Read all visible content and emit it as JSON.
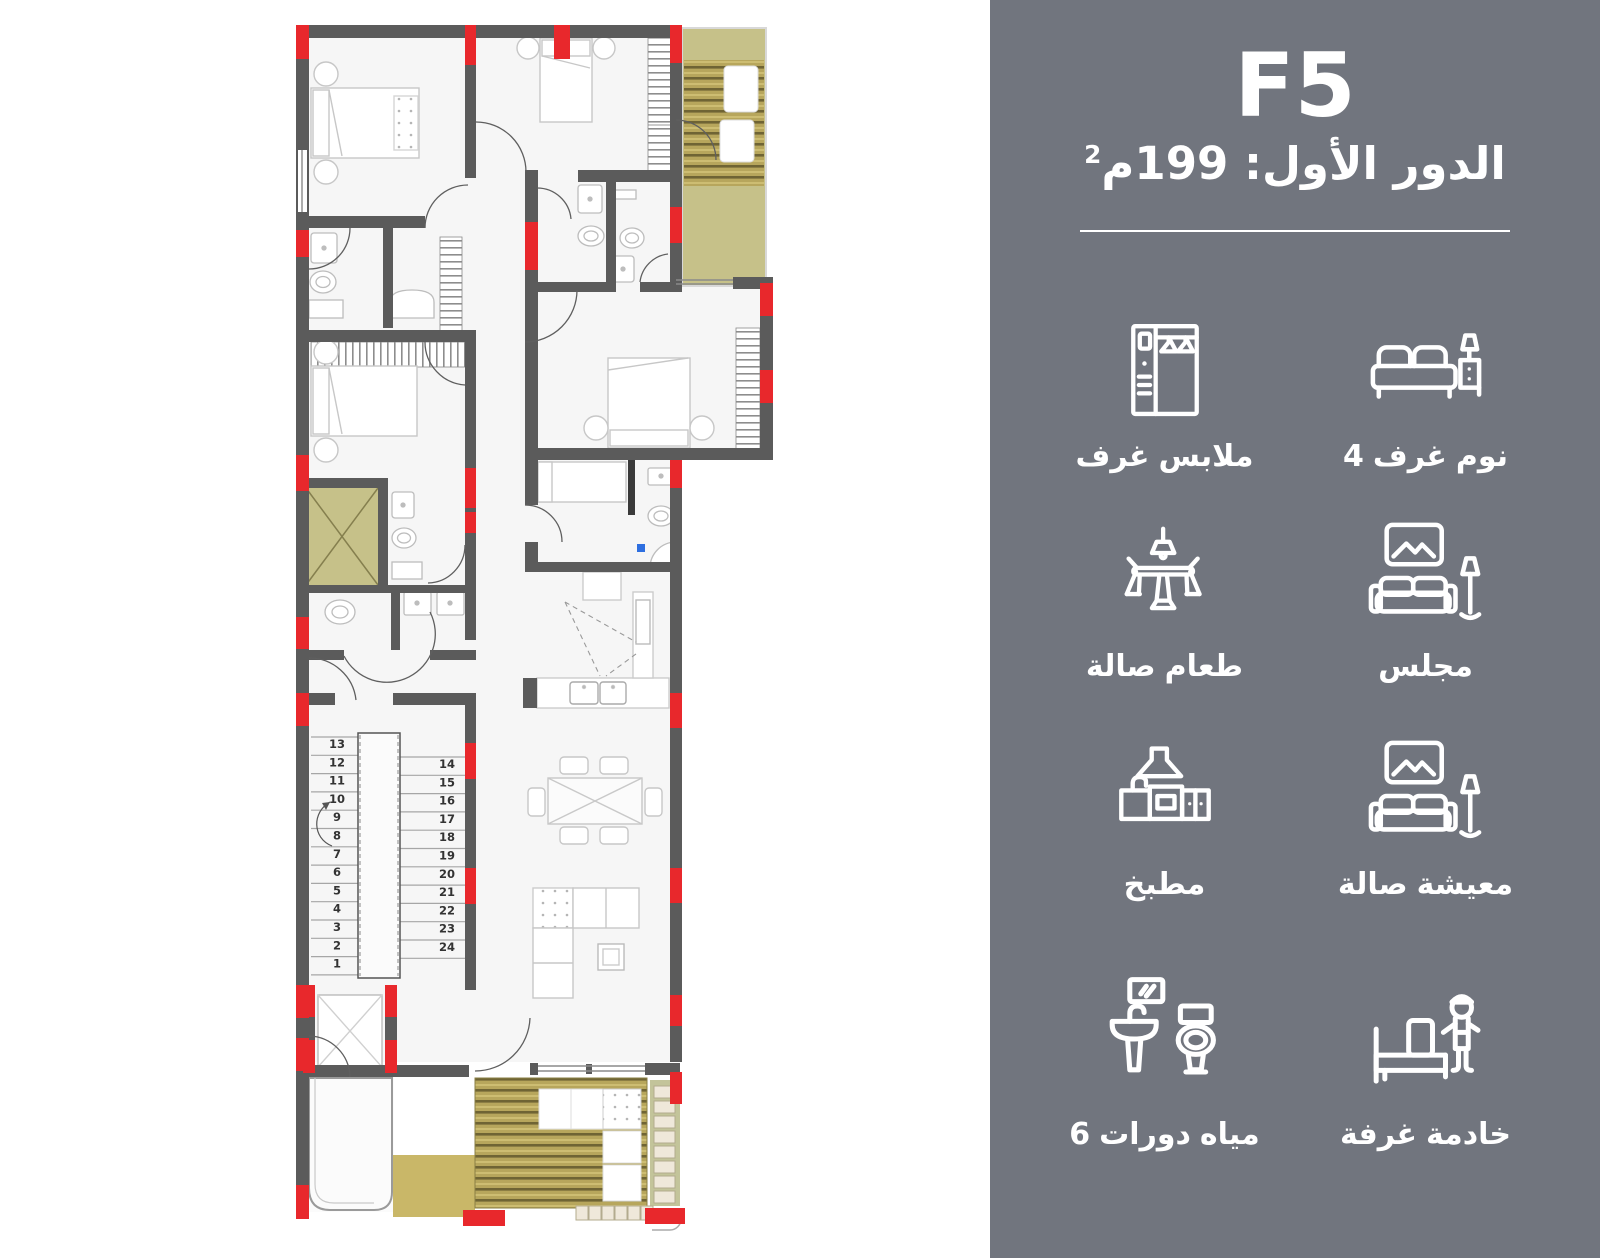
{
  "panel": {
    "title": "F5",
    "subtitle_text": "الدور الأول: 199م",
    "subtitle_sup": "2",
    "bg_color": "#71757e",
    "text_color": "#ffffff",
    "features": [
      {
        "id": "dressing-rooms",
        "icon": "wardrobe-icon",
        "label": "غرف ملابس"
      },
      {
        "id": "bedrooms",
        "icon": "bed-icon",
        "label": "4 غرف نوم"
      },
      {
        "id": "dining-room",
        "icon": "dining-table-icon",
        "label": "صالة طعام"
      },
      {
        "id": "majlis",
        "icon": "sofa-lamp-icon",
        "label": "مجلس"
      },
      {
        "id": "kitchen",
        "icon": "kitchen-icon",
        "label": "مطبخ"
      },
      {
        "id": "living-room",
        "icon": "sofa-lamp-icon",
        "label": "صالة معيشة"
      },
      {
        "id": "bathrooms",
        "icon": "bathroom-icon",
        "label": "6 دورات مياه"
      },
      {
        "id": "maid-room",
        "icon": "maid-room-icon",
        "label": "غرفة خادمة"
      }
    ]
  },
  "floorplan": {
    "colors": {
      "wall": "#5b5b5b",
      "column": "#e8282c",
      "room": "#f6f6f6",
      "balcony_khaki": "#c6c189",
      "terrace_patch": "#c9b768",
      "wood": "#b7a65c",
      "wood_line": "#6f6434",
      "steps_strip": "#c3c49a",
      "tile": "#efe8da",
      "furniture": "#c7c7c7",
      "accent_blue": "#2e6fe0"
    },
    "stairs": {
      "left_numbers": [
        "13",
        "12",
        "11",
        "10",
        "9",
        "8",
        "7",
        "6",
        "5",
        "4",
        "3",
        "2",
        "1"
      ],
      "right_numbers": [
        "14",
        "15",
        "16",
        "17",
        "18",
        "19",
        "20",
        "21",
        "22",
        "23",
        "24"
      ]
    }
  }
}
